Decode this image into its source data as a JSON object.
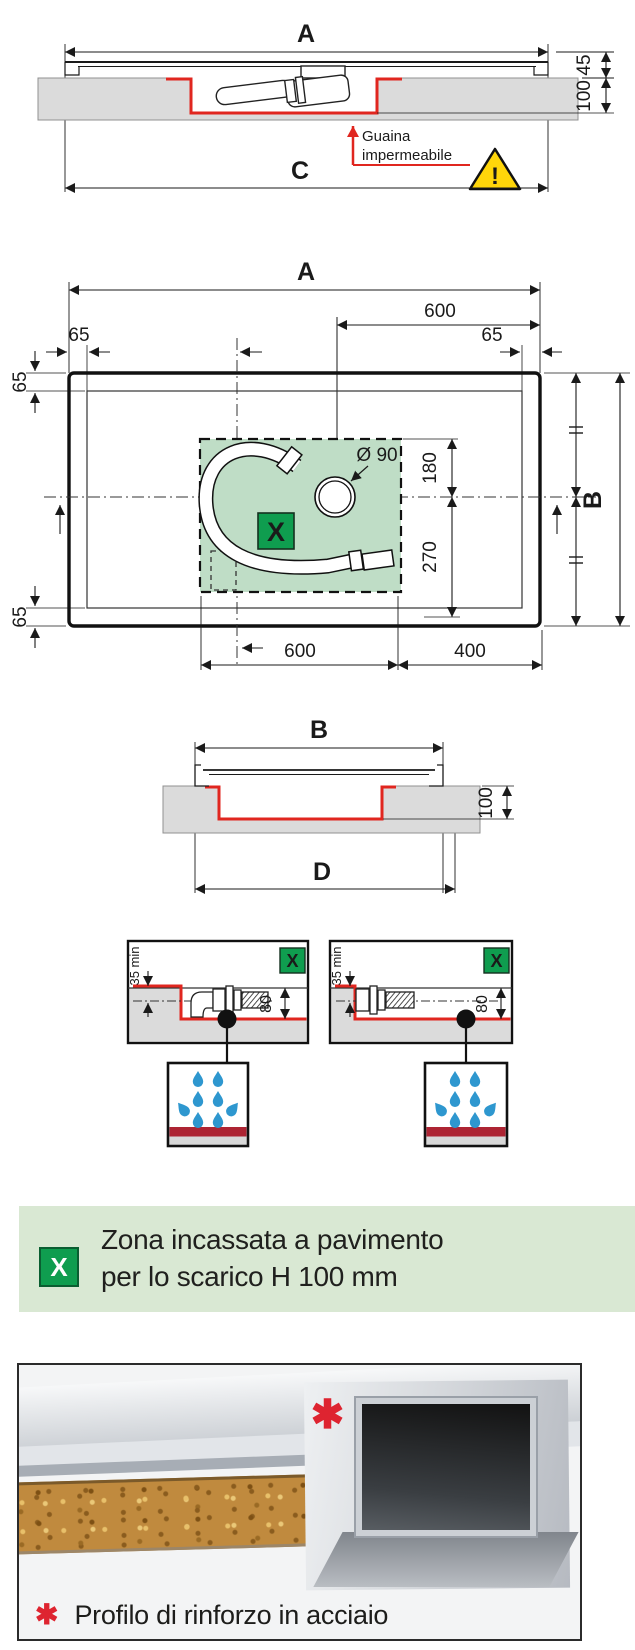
{
  "colors": {
    "dimension_red": "#e0261f",
    "membrane_red_strip": "#ad2433",
    "x_badge_green": "#0f9d4f",
    "drain_zone_green": "#bfddc6",
    "banner_green": "#d9e8d3",
    "drop_blue": "#2e97cf",
    "warning_yellow": "#ffd60a",
    "floor_gray": "#dbdbdb"
  },
  "section_a": {
    "label_a": "A",
    "dim_45": "45",
    "dim_100": "100",
    "note_line1": "Guaina",
    "note_line2": "impermeabile",
    "label_c": "C",
    "warning_mark": "!"
  },
  "plan": {
    "label_a": "A",
    "dim_top_600": "600",
    "dim_tl_65": "65",
    "dim_tr_65": "65",
    "dim_left_top_65": "65",
    "dim_left_bottom_65": "65",
    "drain_diameter": "Ø 90",
    "dim_180": "180",
    "dim_270": "270",
    "x_marker": "X",
    "label_b": "B",
    "dim_bottom_600": "600",
    "dim_bottom_400": "400"
  },
  "section_b": {
    "label_b": "B",
    "dim_100": "100",
    "label_d": "D"
  },
  "details": {
    "left": {
      "x_marker": "X",
      "dim_min": "35 min",
      "dim_80": "80"
    },
    "right": {
      "x_marker": "X",
      "dim_min": "35 min",
      "dim_80": "80"
    }
  },
  "legend": {
    "x_marker": "X",
    "line1": "Zona incassata a pavimento",
    "line2": "per lo scarico H 100 mm"
  },
  "photo": {
    "asterisk_marker": "✱",
    "caption": "Profilo di rinforzo in acciaio"
  }
}
